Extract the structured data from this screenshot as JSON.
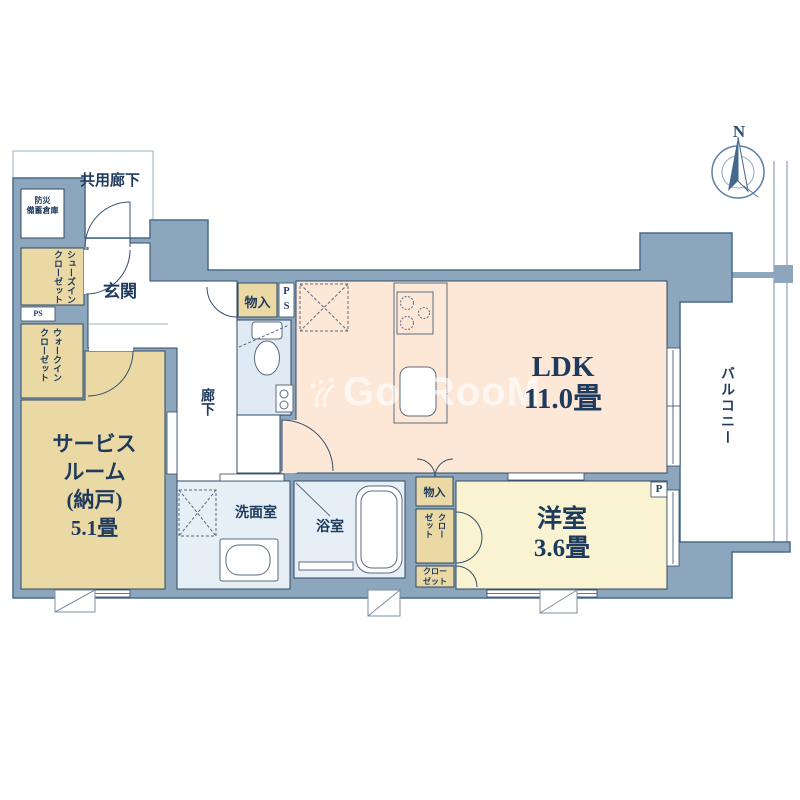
{
  "watermark": {
    "text": "GooRooM"
  },
  "compass": {
    "north": "N"
  },
  "rooms": {
    "common_corridor": {
      "label": "共用廊下"
    },
    "disaster_storage": {
      "line1": "防災",
      "line2": "備蓄倉庫"
    },
    "shoes_closet": {
      "line1": "シューズイン",
      "line2": "クローゼット"
    },
    "entrance": {
      "label": "玄関"
    },
    "ps_left": {
      "label": "PS"
    },
    "walk_in_closet": {
      "line1": "ウォークイン",
      "line2": "クローゼット"
    },
    "service_room": {
      "line1": "サービス",
      "line2": "ルーム",
      "line3": "(納戸)",
      "line4": "5.1畳"
    },
    "corridor": {
      "label": "廊下"
    },
    "hall_storage": {
      "label": "物入"
    },
    "ps_center": {
      "line1": "P",
      "line2": "S"
    },
    "ldk": {
      "line1": "LDK",
      "line2": "11.0畳"
    },
    "washroom": {
      "label": "洗面室"
    },
    "bathroom": {
      "label": "浴室"
    },
    "ldk_storage": {
      "label": "物入"
    },
    "closet_tall": {
      "line1": "クロー",
      "line2": "ゼット"
    },
    "closet_small": {
      "line1": "クロー",
      "line2": "ゼット"
    },
    "western_room": {
      "line1": "洋室",
      "line2": "3.6畳"
    },
    "balcony": {
      "label": "バルコニー"
    },
    "pipe_p": {
      "label": "P"
    }
  },
  "colors": {
    "wall": "#8ca6be",
    "wall_outline": "#4a6a8a",
    "room_stroke": "#2f4a63",
    "ldk_floor": "#fde8d8",
    "tatami_cream": "#faf3d2",
    "closet_tan": "#ead8a5",
    "wet_floor": "#e6eef6",
    "toilet_floor": "#dfeaf4",
    "text": "#1e3a5c"
  }
}
